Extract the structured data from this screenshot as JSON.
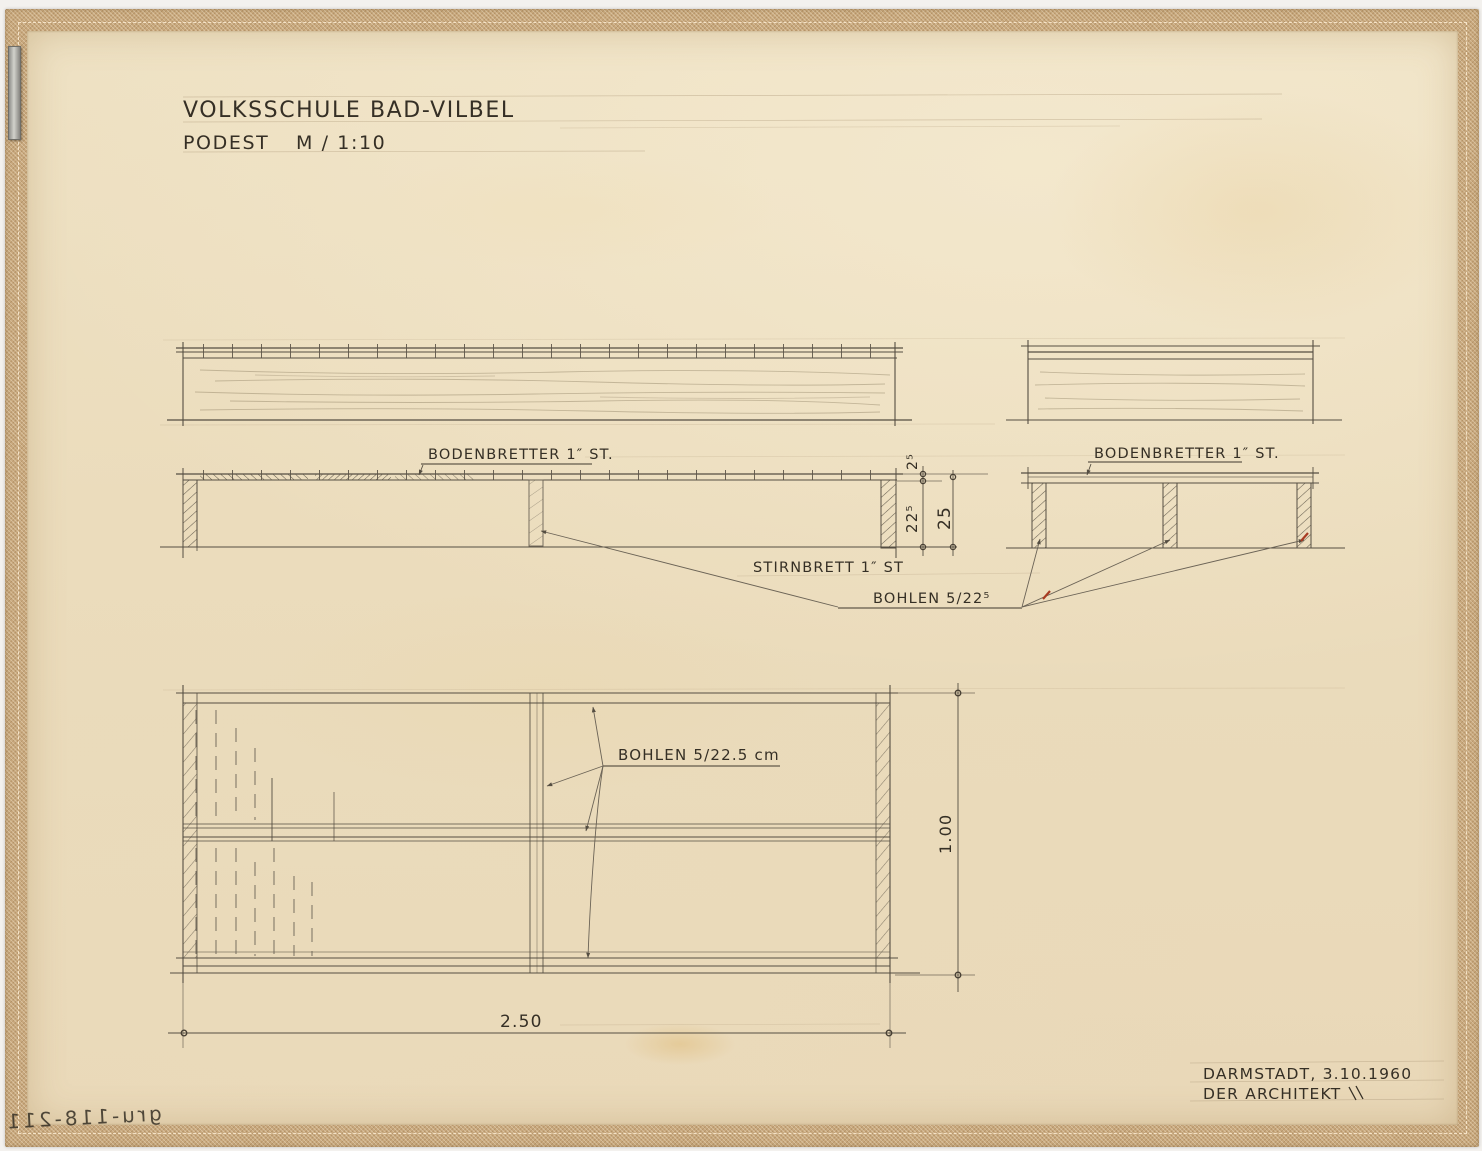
{
  "sheet": {
    "title": {
      "line1": "VOLKSSCHULE BAD-VILBEL",
      "line2_left": "PODEST",
      "line2_right": "M / 1:10"
    },
    "annotations": {
      "bodenbretter_left": "BODENBRETTER 1″ ST.",
      "bodenbretter_right": "BODENBRETTER 1″ ST.",
      "stirnbrett": "STIRNBRETT 1″ ST",
      "bohlen_section": "BOHLEN 5/22⁵",
      "bohlen_plan": "BOHLEN 5/22.5 cm"
    },
    "dimensions": {
      "deck_thickness": "2⁵",
      "clear_height": "22⁵",
      "total_height": "25",
      "plan_width": "1.00",
      "plan_length": "2.50"
    },
    "footer": {
      "place_date": "DARMSTADT, 3.10.1960",
      "signature": "DER ARCHITEKT"
    },
    "reverse_stamp": "gru-118-211",
    "colors": {
      "paper": "#ebdcbc",
      "tape": "#c8a87d",
      "pencil": "#554e42",
      "ink": "#352f25",
      "red_accent": "#a83b22"
    }
  }
}
